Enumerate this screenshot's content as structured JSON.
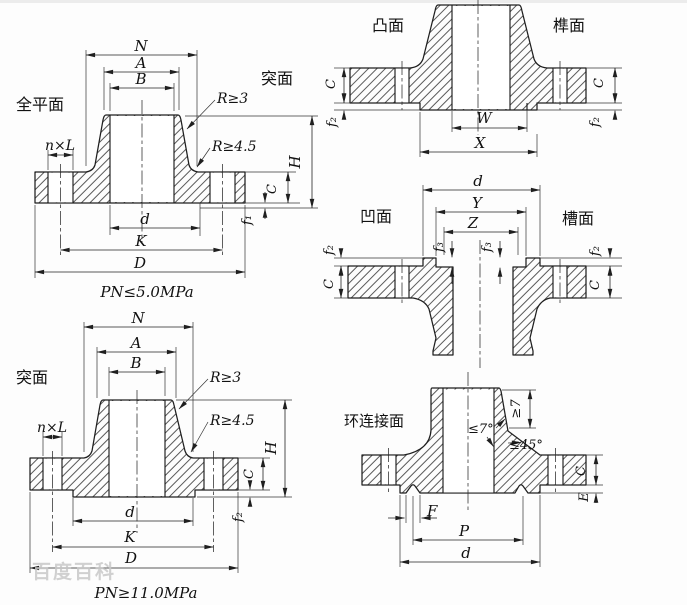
{
  "colors": {
    "ink": "#1f1f1f",
    "paper": "#fdfdfd",
    "hatch": "#3c3c3c",
    "watermark": "#c9c9c9"
  },
  "watermark": "百度百科",
  "d1": {
    "face_label": "全平面",
    "face_label_right": "突面",
    "pressure": "PN≤5.0MPa",
    "N": "N",
    "A": "A",
    "B": "B",
    "nxl": "n×L",
    "r3": "R≥3",
    "r45": "R≥4.5",
    "d": "d",
    "K": "K",
    "D": "D",
    "H": "H",
    "C": "C",
    "f1": "f₁"
  },
  "d2": {
    "left_label": "凸面",
    "right_label": "榫面",
    "W": "W",
    "X": "X",
    "C_left": "C",
    "C_right": "C",
    "f2_left": "f₂",
    "f2_right": "f₂"
  },
  "d3": {
    "left_label": "凹面",
    "right_label": "槽面",
    "d": "d",
    "Y": "Y",
    "Z": "Z",
    "f3_left": "f₃",
    "f3_right": "f₃",
    "f2_left": "f₂",
    "f2_right": "f₂",
    "C_left": "C",
    "C_right": "C"
  },
  "d4": {
    "face_label": "突面",
    "pressure": "PN≥11.0MPa",
    "N": "N",
    "A": "A",
    "B": "B",
    "nxl": "n×L",
    "r3": "R≥3",
    "r45": "R≥4.5",
    "d": "d",
    "K": "K",
    "D": "D",
    "H": "H",
    "C": "C",
    "f2": "f₂"
  },
  "d5": {
    "face_label": "环连接面",
    "ge7": "≥7",
    "le7": "≤7°",
    "le45": "≤45°",
    "F": "F",
    "P": "P",
    "d": "d",
    "C": "C",
    "E": "E"
  }
}
